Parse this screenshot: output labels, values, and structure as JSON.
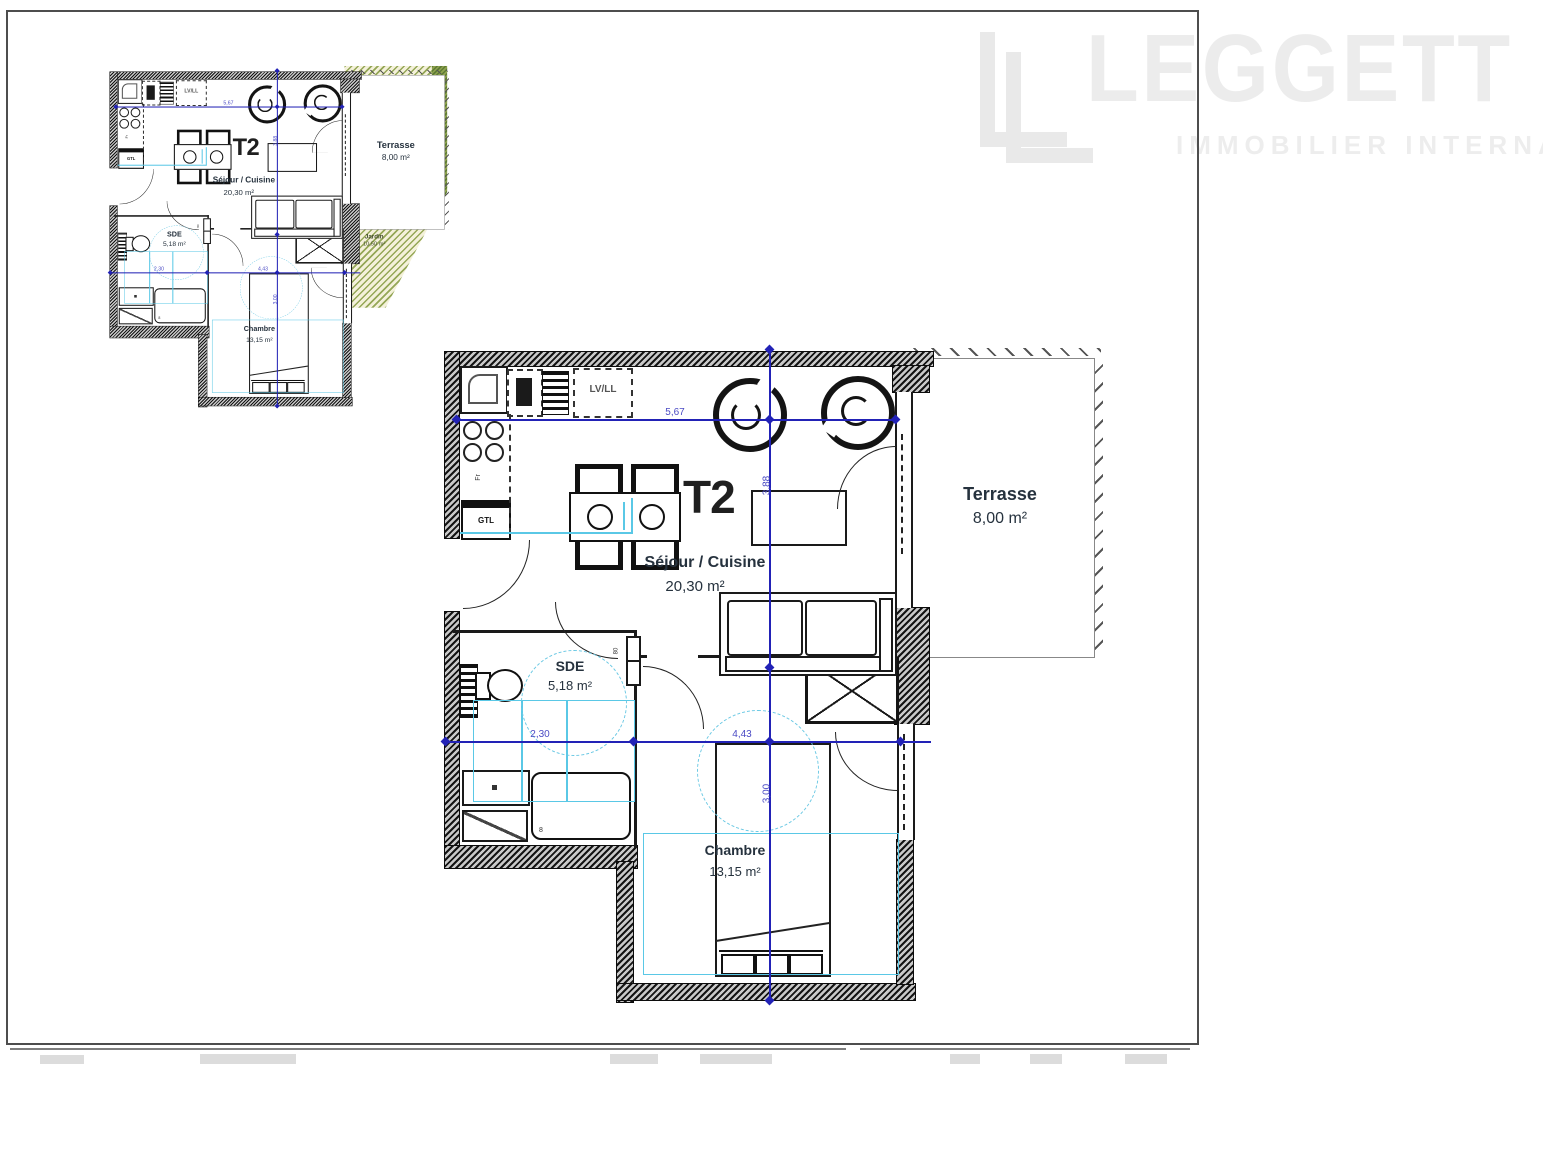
{
  "watermark": {
    "brand": "LEGGETT",
    "tagline": "IMMOBILIER INTERNATIONAL"
  },
  "plan": {
    "unit_label": "T2",
    "rooms": {
      "sejour": {
        "name": "Séjour / Cuisine",
        "area": "20,30 m²"
      },
      "terrasse": {
        "name": "Terrasse",
        "area": "8,00 m²"
      },
      "sde": {
        "name": "SDE",
        "area": "5,18 m²"
      },
      "chambre": {
        "name": "Chambre",
        "area": "13,15 m²"
      },
      "jardin": {
        "name": "Jardin",
        "area": "10,50 m²"
      },
      "placard": {
        "name": "Pl."
      }
    },
    "fixtures": {
      "lv_ll": "LV/LL",
      "gtl": "GTL",
      "fr": "Fr",
      "drain": "8",
      "door_width": "80"
    },
    "dimensions": {
      "width_sejour": "5,67",
      "height_sejour": "3,88",
      "width_sde": "2,30",
      "width_chambre": "4,43",
      "height_chambre": "3,00"
    },
    "colors": {
      "dimension_blue": "#2222b6",
      "accessory_cyan": "#5ac8e6",
      "label_dark": "#26323e",
      "garden_green": "#8fa24d",
      "watermark_gray": "#ececec"
    }
  }
}
